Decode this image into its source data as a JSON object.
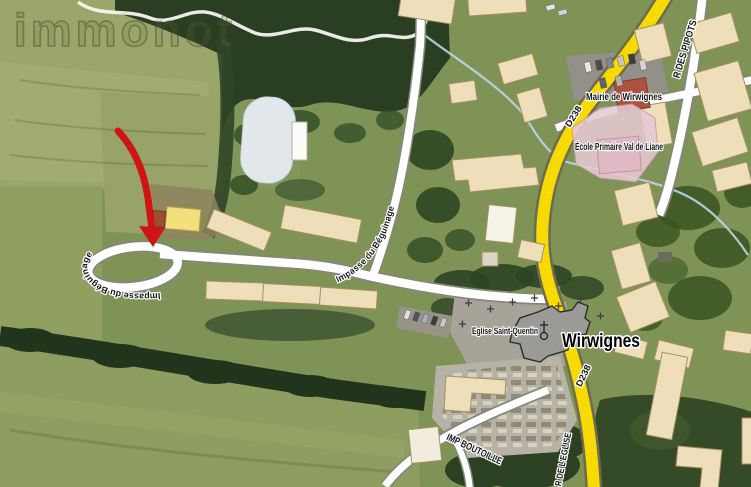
{
  "map": {
    "watermark": "immonot",
    "town": "Wirwignes",
    "pois": {
      "mairie": "Mairie de Wirwignes",
      "school": "École Primaire Val de Liane",
      "church": "Eglise Saint-Quentin"
    },
    "roads": {
      "pipots": "R DES PIPOTS",
      "d238_top": "D238",
      "d238_bottom": "D238",
      "eglise": "R DE L'EGLISE",
      "boutoille": "IMP BOUTOILLE",
      "beguinage_curve": "Impasse du Béguinage",
      "beguinage_loop": "Impasse du Béguinage"
    },
    "colors": {
      "road_primary": "#f6da00",
      "road_secondary": "#ffffff",
      "building": "#eedeba",
      "school_zone": "#e7c9d1",
      "church": "#9a9a96",
      "town_hall": "#ad5240",
      "annotation_arrow": "#d01414",
      "field": "#7f9357",
      "pond": "#e2e7ec"
    }
  }
}
